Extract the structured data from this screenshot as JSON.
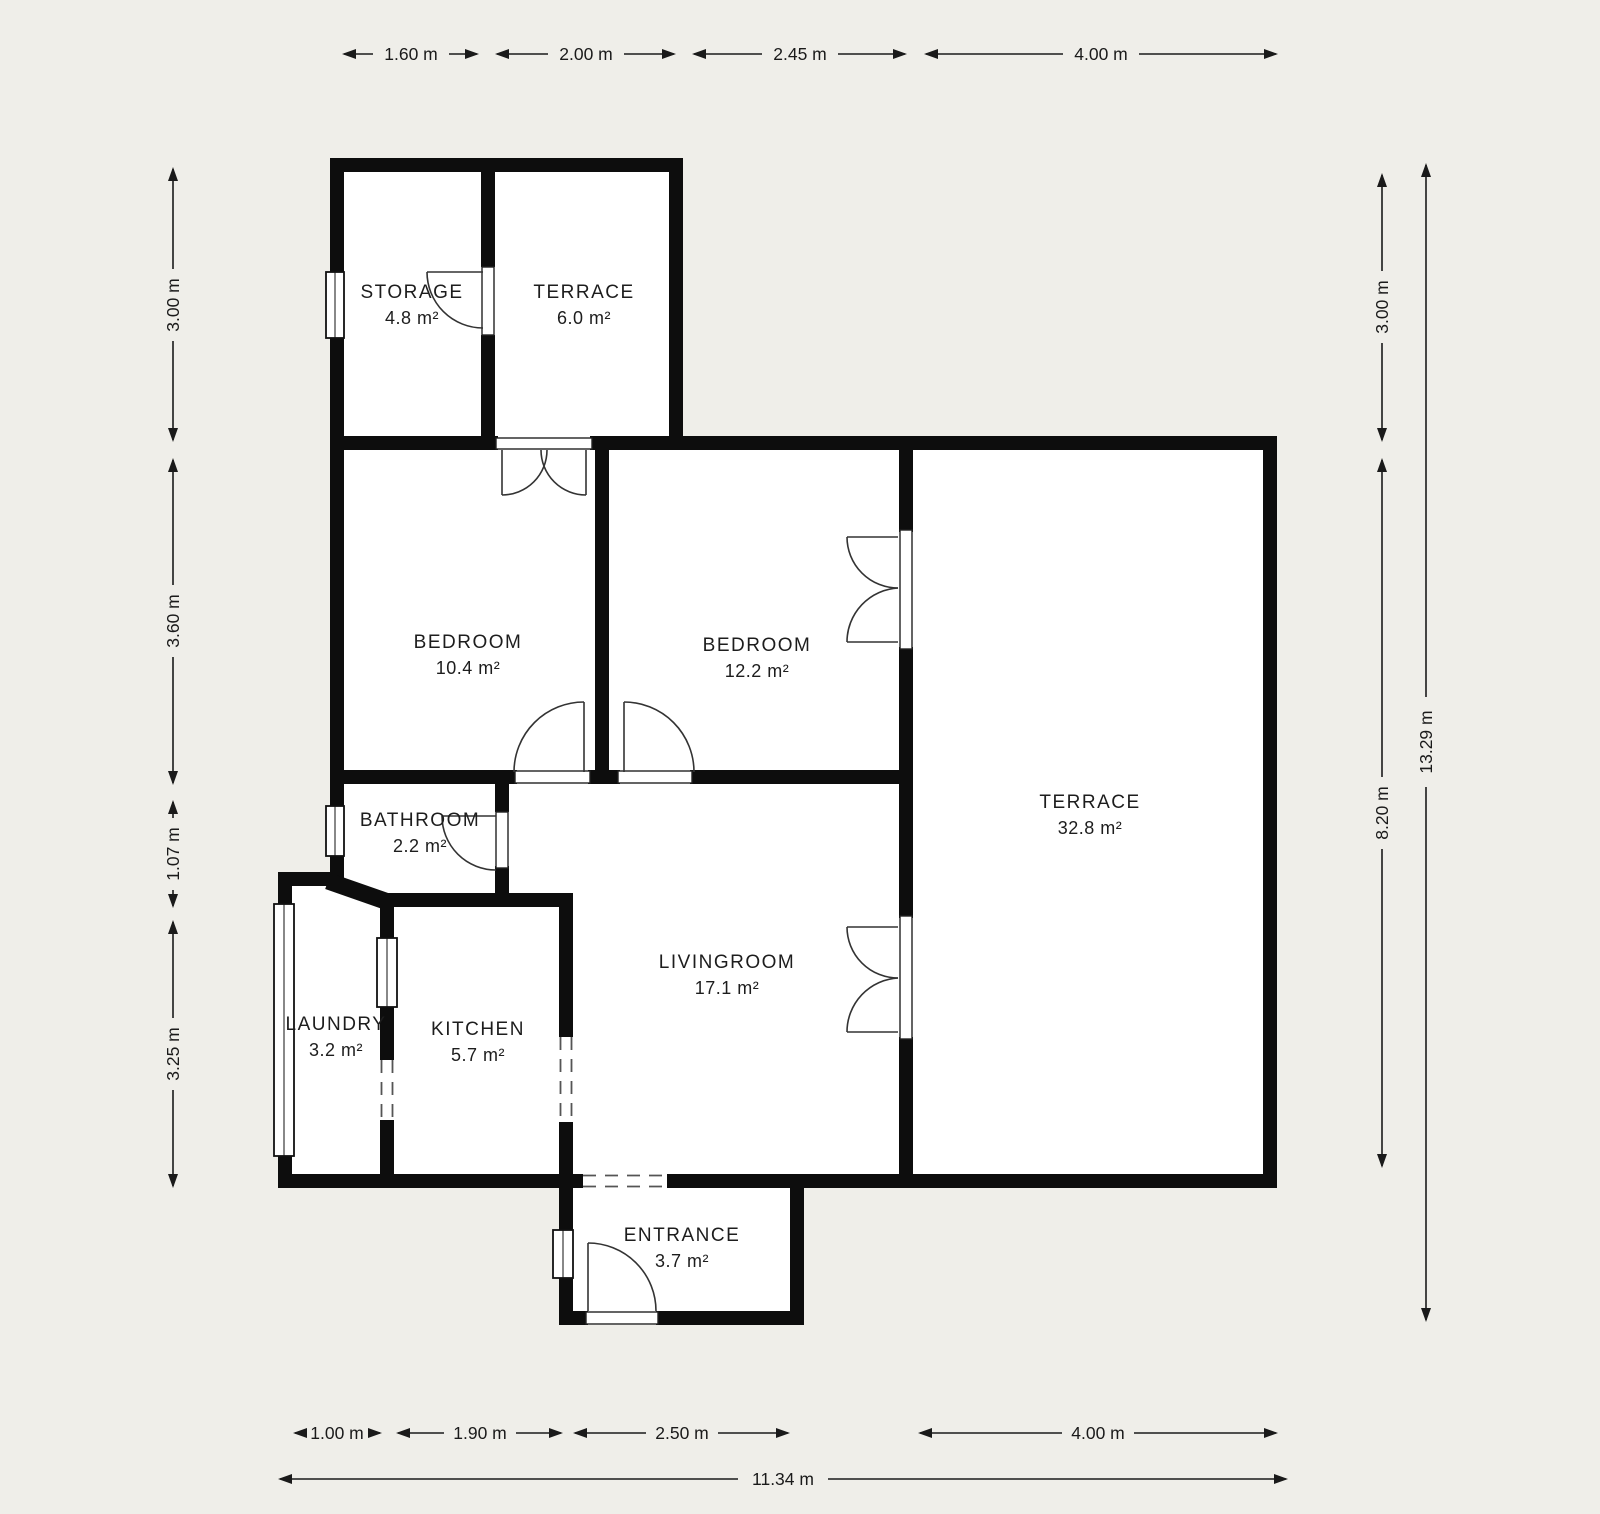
{
  "rooms": [
    {
      "id": "storage",
      "name": "STORAGE",
      "area": "4.8 m²"
    },
    {
      "id": "terrace-small",
      "name": "TERRACE",
      "area": "6.0 m²"
    },
    {
      "id": "bedroom-1",
      "name": "BEDROOM",
      "area": "10.4 m²"
    },
    {
      "id": "bedroom-2",
      "name": "BEDROOM",
      "area": "12.2 m²"
    },
    {
      "id": "bathroom",
      "name": "BATHROOM",
      "area": "2.2 m²"
    },
    {
      "id": "laundry",
      "name": "LAUNDRY",
      "area": "3.2 m²"
    },
    {
      "id": "kitchen",
      "name": "KITCHEN",
      "area": "5.7 m²"
    },
    {
      "id": "livingroom",
      "name": "LIVINGROOM",
      "area": "17.1 m²"
    },
    {
      "id": "terrace-large",
      "name": "TERRACE",
      "area": "32.8 m²"
    },
    {
      "id": "entrance",
      "name": "ENTRANCE",
      "area": "3.7 m²"
    }
  ],
  "dimensions": {
    "top": [
      "1.60 m",
      "2.00 m",
      "2.45 m",
      "4.00 m"
    ],
    "bottom": [
      "1.00 m",
      "1.90 m",
      "2.50 m",
      "4.00 m"
    ],
    "bottom_total": "11.34 m",
    "left": [
      "3.00 m",
      "3.60 m",
      "1.07 m",
      "3.25 m"
    ],
    "right": [
      "3.00 m",
      "8.20 m"
    ],
    "right_total": "13.29 m"
  },
  "colors": {
    "background": "#efeee9",
    "wall": "#0d0d0d",
    "floor": "#ffffff",
    "line": "#1a1a1a",
    "text": "#1d1d1d"
  }
}
